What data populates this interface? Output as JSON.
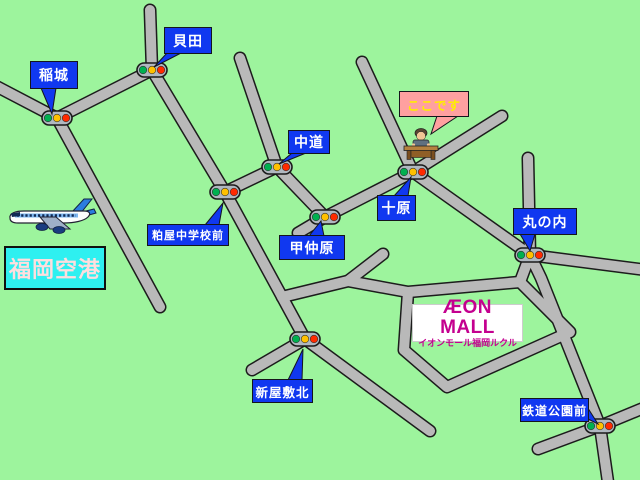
{
  "map": {
    "colors": {
      "background": "#9df49d",
      "road_fill": "#b9b9b9",
      "road_border": "#1c1c1c",
      "label_blue": "#1038f0",
      "label_text_white": "#ffffff",
      "here_pink": "#ffa0a0",
      "here_text_yellow": "#ffee00",
      "airport_cyan": "#2ef0f0",
      "airport_text": "#ffdede",
      "aeon_magenta": "#c4008f",
      "light_body": "#b0b8c0",
      "light_green": "#00b050",
      "light_yellow": "#ffc000",
      "light_red": "#ff2a00"
    },
    "airport": {
      "name": "福岡空港",
      "box": [
        4,
        246,
        102,
        44
      ],
      "icon": "airplane-icon"
    },
    "mall": {
      "logo": "ÆON MALL",
      "subtitle": "イオンモール福岡ルクル",
      "box": [
        412,
        304,
        111,
        38
      ]
    },
    "here_marker": {
      "icon": "person-at-desk-icon"
    },
    "labels": [
      {
        "id": "inagi",
        "text": "稲城",
        "box": [
          30,
          61,
          48,
          28
        ],
        "tail": [
          [
            41,
            88
          ],
          [
            56,
            88
          ],
          [
            52,
            114
          ]
        ]
      },
      {
        "id": "kaida",
        "text": "貝田",
        "box": [
          164,
          27,
          48,
          27
        ],
        "tail": [
          [
            167,
            53
          ],
          [
            181,
            53
          ],
          [
            154,
            67
          ]
        ]
      },
      {
        "id": "nakamichi",
        "text": "中道",
        "box": [
          288,
          130,
          42,
          24
        ],
        "tail": [
          [
            292,
            153
          ],
          [
            306,
            153
          ],
          [
            279,
            164
          ]
        ]
      },
      {
        "id": "kokodesu",
        "text": "ここです",
        "box": [
          399,
          91,
          70,
          26
        ],
        "fill": "#ffa0a0",
        "text_color": "#ffee00",
        "tail": [
          [
            437,
            116
          ],
          [
            458,
            116
          ],
          [
            431,
            134
          ]
        ]
      },
      {
        "id": "tobaru",
        "text": "十原",
        "box": [
          377,
          195,
          39,
          26
        ],
        "tail": [
          [
            394,
            196
          ],
          [
            408,
            196
          ],
          [
            411,
            177
          ]
        ]
      },
      {
        "id": "konakabaru",
        "text": "甲仲原",
        "box": [
          279,
          235,
          66,
          25
        ],
        "tail": [
          [
            309,
            236
          ],
          [
            324,
            236
          ],
          [
            321,
            221
          ]
        ]
      },
      {
        "id": "marunouchi",
        "text": "丸の内",
        "box": [
          513,
          208,
          64,
          27
        ],
        "tail": [
          [
            520,
            234
          ],
          [
            535,
            234
          ],
          [
            530,
            251
          ]
        ]
      },
      {
        "id": "kasuya-chugakko-mae",
        "text": "粕屋中学校前",
        "box": [
          147,
          224,
          82,
          22
        ],
        "tail": [
          [
            205,
            225
          ],
          [
            219,
            225
          ],
          [
            223,
            203
          ]
        ]
      },
      {
        "id": "shinyashiki-kita",
        "text": "新屋敷北",
        "box": [
          252,
          379,
          61,
          24
        ],
        "tail": [
          [
            288,
            380
          ],
          [
            302,
            380
          ],
          [
            303,
            349
          ]
        ]
      },
      {
        "id": "tetsudo-koen-mae",
        "text": "鉄道公園前",
        "box": [
          520,
          398,
          69,
          24
        ],
        "tail": [
          [
            584,
            402
          ],
          [
            584,
            417
          ],
          [
            598,
            424
          ]
        ]
      }
    ],
    "traffic_lights": [
      {
        "name": "inagi",
        "x": 57,
        "y": 118
      },
      {
        "name": "kaida",
        "x": 152,
        "y": 70
      },
      {
        "name": "kasuya-chugakko-mae",
        "x": 225,
        "y": 192
      },
      {
        "name": "nakamichi",
        "x": 277,
        "y": 167
      },
      {
        "name": "konakabaru",
        "x": 325,
        "y": 217
      },
      {
        "name": "tobaru",
        "x": 413,
        "y": 172
      },
      {
        "name": "marunouchi",
        "x": 530,
        "y": 255
      },
      {
        "name": "shinyashiki-kita",
        "x": 305,
        "y": 339
      },
      {
        "name": "tetsudo-koen-mae",
        "x": 600,
        "y": 426
      }
    ],
    "roads": [
      {
        "name": "inagi-west",
        "points": [
          [
            -8,
            84
          ],
          [
            57,
            118
          ]
        ]
      },
      {
        "name": "inagi-south-deadend",
        "points": [
          [
            57,
            118
          ],
          [
            160,
            307
          ]
        ]
      },
      {
        "name": "inagi-kaida",
        "points": [
          [
            57,
            118
          ],
          [
            152,
            70
          ]
        ]
      },
      {
        "name": "kaida-north",
        "points": [
          [
            152,
            70
          ],
          [
            150,
            10
          ]
        ]
      },
      {
        "name": "kaida-kasuya",
        "points": [
          [
            152,
            70
          ],
          [
            225,
            192
          ]
        ]
      },
      {
        "name": "kasuya-nakamichi",
        "points": [
          [
            225,
            192
          ],
          [
            277,
            167
          ]
        ]
      },
      {
        "name": "nakamichi-north-deadend",
        "points": [
          [
            277,
            167
          ],
          [
            240,
            58
          ]
        ]
      },
      {
        "name": "nakamichi-konakabaru",
        "points": [
          [
            277,
            167
          ],
          [
            325,
            217
          ]
        ]
      },
      {
        "name": "konakabaru-stub",
        "points": [
          [
            325,
            217
          ],
          [
            298,
            233
          ]
        ]
      },
      {
        "name": "konakabaru-tobaru",
        "points": [
          [
            325,
            217
          ],
          [
            413,
            172
          ]
        ]
      },
      {
        "name": "tobaru-northwest-deadend",
        "points": [
          [
            413,
            172
          ],
          [
            362,
            62
          ]
        ]
      },
      {
        "name": "tobaru-northeast-deadend",
        "points": [
          [
            413,
            172
          ],
          [
            502,
            116
          ]
        ]
      },
      {
        "name": "tobaru-marunouchi",
        "points": [
          [
            413,
            172
          ],
          [
            530,
            255
          ]
        ]
      },
      {
        "name": "marunouchi-north-deadend",
        "points": [
          [
            530,
            255
          ],
          [
            528,
            158
          ]
        ]
      },
      {
        "name": "marunouchi-east",
        "points": [
          [
            530,
            255
          ],
          [
            646,
            270
          ]
        ]
      },
      {
        "name": "marunouchi-tetsudokoen",
        "points": [
          [
            530,
            255
          ],
          [
            541,
            278
          ],
          [
            600,
            426
          ]
        ]
      },
      {
        "name": "tetsudokoen-south",
        "points": [
          [
            600,
            426
          ],
          [
            608,
            482
          ]
        ]
      },
      {
        "name": "tetsudokoen-cross",
        "points": [
          [
            538,
            449
          ],
          [
            600,
            426
          ],
          [
            646,
            407
          ]
        ]
      },
      {
        "name": "kasuya-shinyashiki",
        "points": [
          [
            225,
            192
          ],
          [
            305,
            339
          ]
        ]
      },
      {
        "name": "shinyashiki-west-stub",
        "points": [
          [
            305,
            339
          ],
          [
            252,
            370
          ]
        ]
      },
      {
        "name": "shinyashiki-southeast-deadend",
        "points": [
          [
            305,
            339
          ],
          [
            430,
            431
          ]
        ]
      },
      {
        "name": "mall-access-west",
        "points": [
          [
            282,
            297
          ],
          [
            348,
            281
          ],
          [
            408,
            292
          ]
        ]
      },
      {
        "name": "mall-access-stub",
        "points": [
          [
            348,
            281
          ],
          [
            383,
            254
          ]
        ]
      },
      {
        "name": "mall-ring",
        "points": [
          [
            408,
            292
          ],
          [
            520,
            282
          ],
          [
            570,
            332
          ],
          [
            447,
            387
          ],
          [
            404,
            350
          ],
          [
            408,
            292
          ]
        ]
      },
      {
        "name": "marunouchi-mall",
        "points": [
          [
            530,
            255
          ],
          [
            520,
            282
          ]
        ]
      }
    ]
  }
}
